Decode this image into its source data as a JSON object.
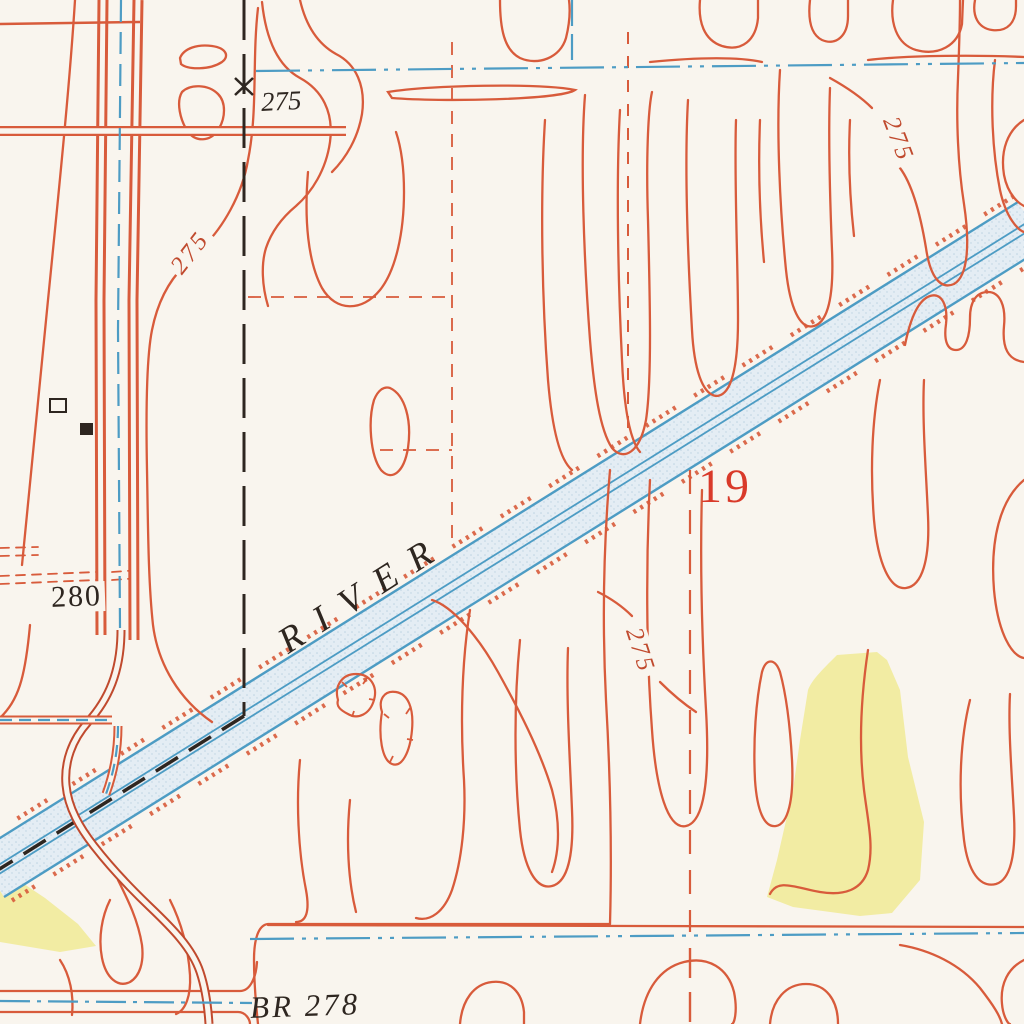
{
  "colors": {
    "bg": "#f9f5ee",
    "contour": "#d85b3b",
    "contour_dark": "#c04a2e",
    "water": "#4d9cc4",
    "water_fill": "#e4edf4",
    "water_dot": "#bdd3e2",
    "ink": "#2e2620",
    "section_red": "#d93a2a",
    "field_yellow": "#f2eca3"
  },
  "labels": {
    "river_name": "RIVER",
    "section_number": "19",
    "spot_elevation_275": "275",
    "contour_275_left": "275",
    "contour_275_upper_right": "275",
    "contour_275_center": "275",
    "contour_280": "280",
    "bridge_label": "BR 278"
  }
}
